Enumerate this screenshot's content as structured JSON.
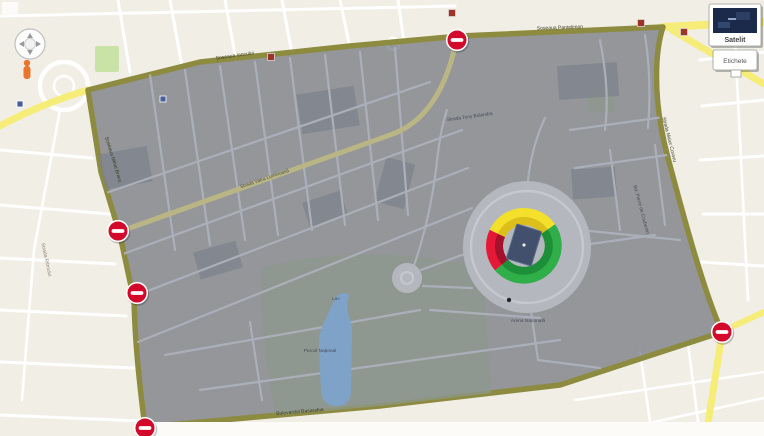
{
  "theme": {
    "colors": {
      "bg": "#f1eee6",
      "road-yellow": "#f6ec78",
      "zone-border": "#8d8b40",
      "zone-fill": "rgba(56,62,78,0.50)",
      "noentry": "#d2092b",
      "sec-yellow": "#f4e02a",
      "sec-green": "#2fae4a",
      "sec-red": "#e51937",
      "pitch": "#42506e",
      "in-water": "#7fa2c8"
    }
  },
  "controls": {
    "map_type": {
      "satellite_label": "Satelit",
      "labels_label": "Etichete"
    }
  },
  "map": {
    "street_labels": [
      {
        "text": "Șoseaua Iancului",
        "x": 235,
        "y": 57,
        "r": -8,
        "tier": "border"
      },
      {
        "text": "Șoseaua Pantelimon",
        "x": 560,
        "y": 29,
        "r": -2,
        "tier": "border"
      },
      {
        "text": "Șoseaua Mihai Bravu",
        "x": 112,
        "y": 160,
        "r": 73,
        "tier": "border"
      },
      {
        "text": "Bulevardul Basarabia",
        "x": 300,
        "y": 413,
        "r": -5,
        "tier": "border"
      },
      {
        "text": "Strada Maior Coravu",
        "x": 668,
        "y": 140,
        "r": 76,
        "tier": "border"
      },
      {
        "text": "Strada Vatra Luminoasă",
        "x": 265,
        "y": 180,
        "r": -19,
        "tier": "in"
      },
      {
        "text": "Strada Tony Bulandra",
        "x": 470,
        "y": 118,
        "r": -8,
        "tier": "in"
      },
      {
        "text": "Parcul Național",
        "x": 320,
        "y": 352,
        "r": 0,
        "tier": "in"
      },
      {
        "text": "Lac",
        "x": 336,
        "y": 300,
        "r": 0,
        "tier": "in"
      },
      {
        "text": "Arena Națională",
        "x": 528,
        "y": 322,
        "r": 0,
        "tier": "in"
      },
      {
        "text": "Bd. Pierre de Coubertin",
        "x": 640,
        "y": 210,
        "r": 75,
        "tier": "in"
      },
      {
        "text": "Strada Ritmului",
        "x": 45,
        "y": 260,
        "r": 78,
        "tier": "out"
      }
    ],
    "no_entry_markers": [
      {
        "x": 457,
        "y": 40
      },
      {
        "x": 118,
        "y": 231
      },
      {
        "x": 137,
        "y": 293
      },
      {
        "x": 145,
        "y": 428
      },
      {
        "x": 722,
        "y": 332
      }
    ],
    "red_poi_markers": [
      {
        "x": 271,
        "y": 57
      },
      {
        "x": 641,
        "y": 23
      },
      {
        "x": 684,
        "y": 32
      },
      {
        "x": 452,
        "y": 13
      }
    ],
    "blue_poi_markers": [
      {
        "x": 20,
        "y": 104
      },
      {
        "x": 163,
        "y": 99
      }
    ]
  },
  "stadium": {
    "sections": [
      {
        "id": "north-stand",
        "color": "#f4e02a"
      },
      {
        "id": "east-south-stand",
        "color": "#2fae4a"
      },
      {
        "id": "west-stand",
        "color": "#e51937"
      }
    ],
    "pitch_color": "#42506e"
  }
}
